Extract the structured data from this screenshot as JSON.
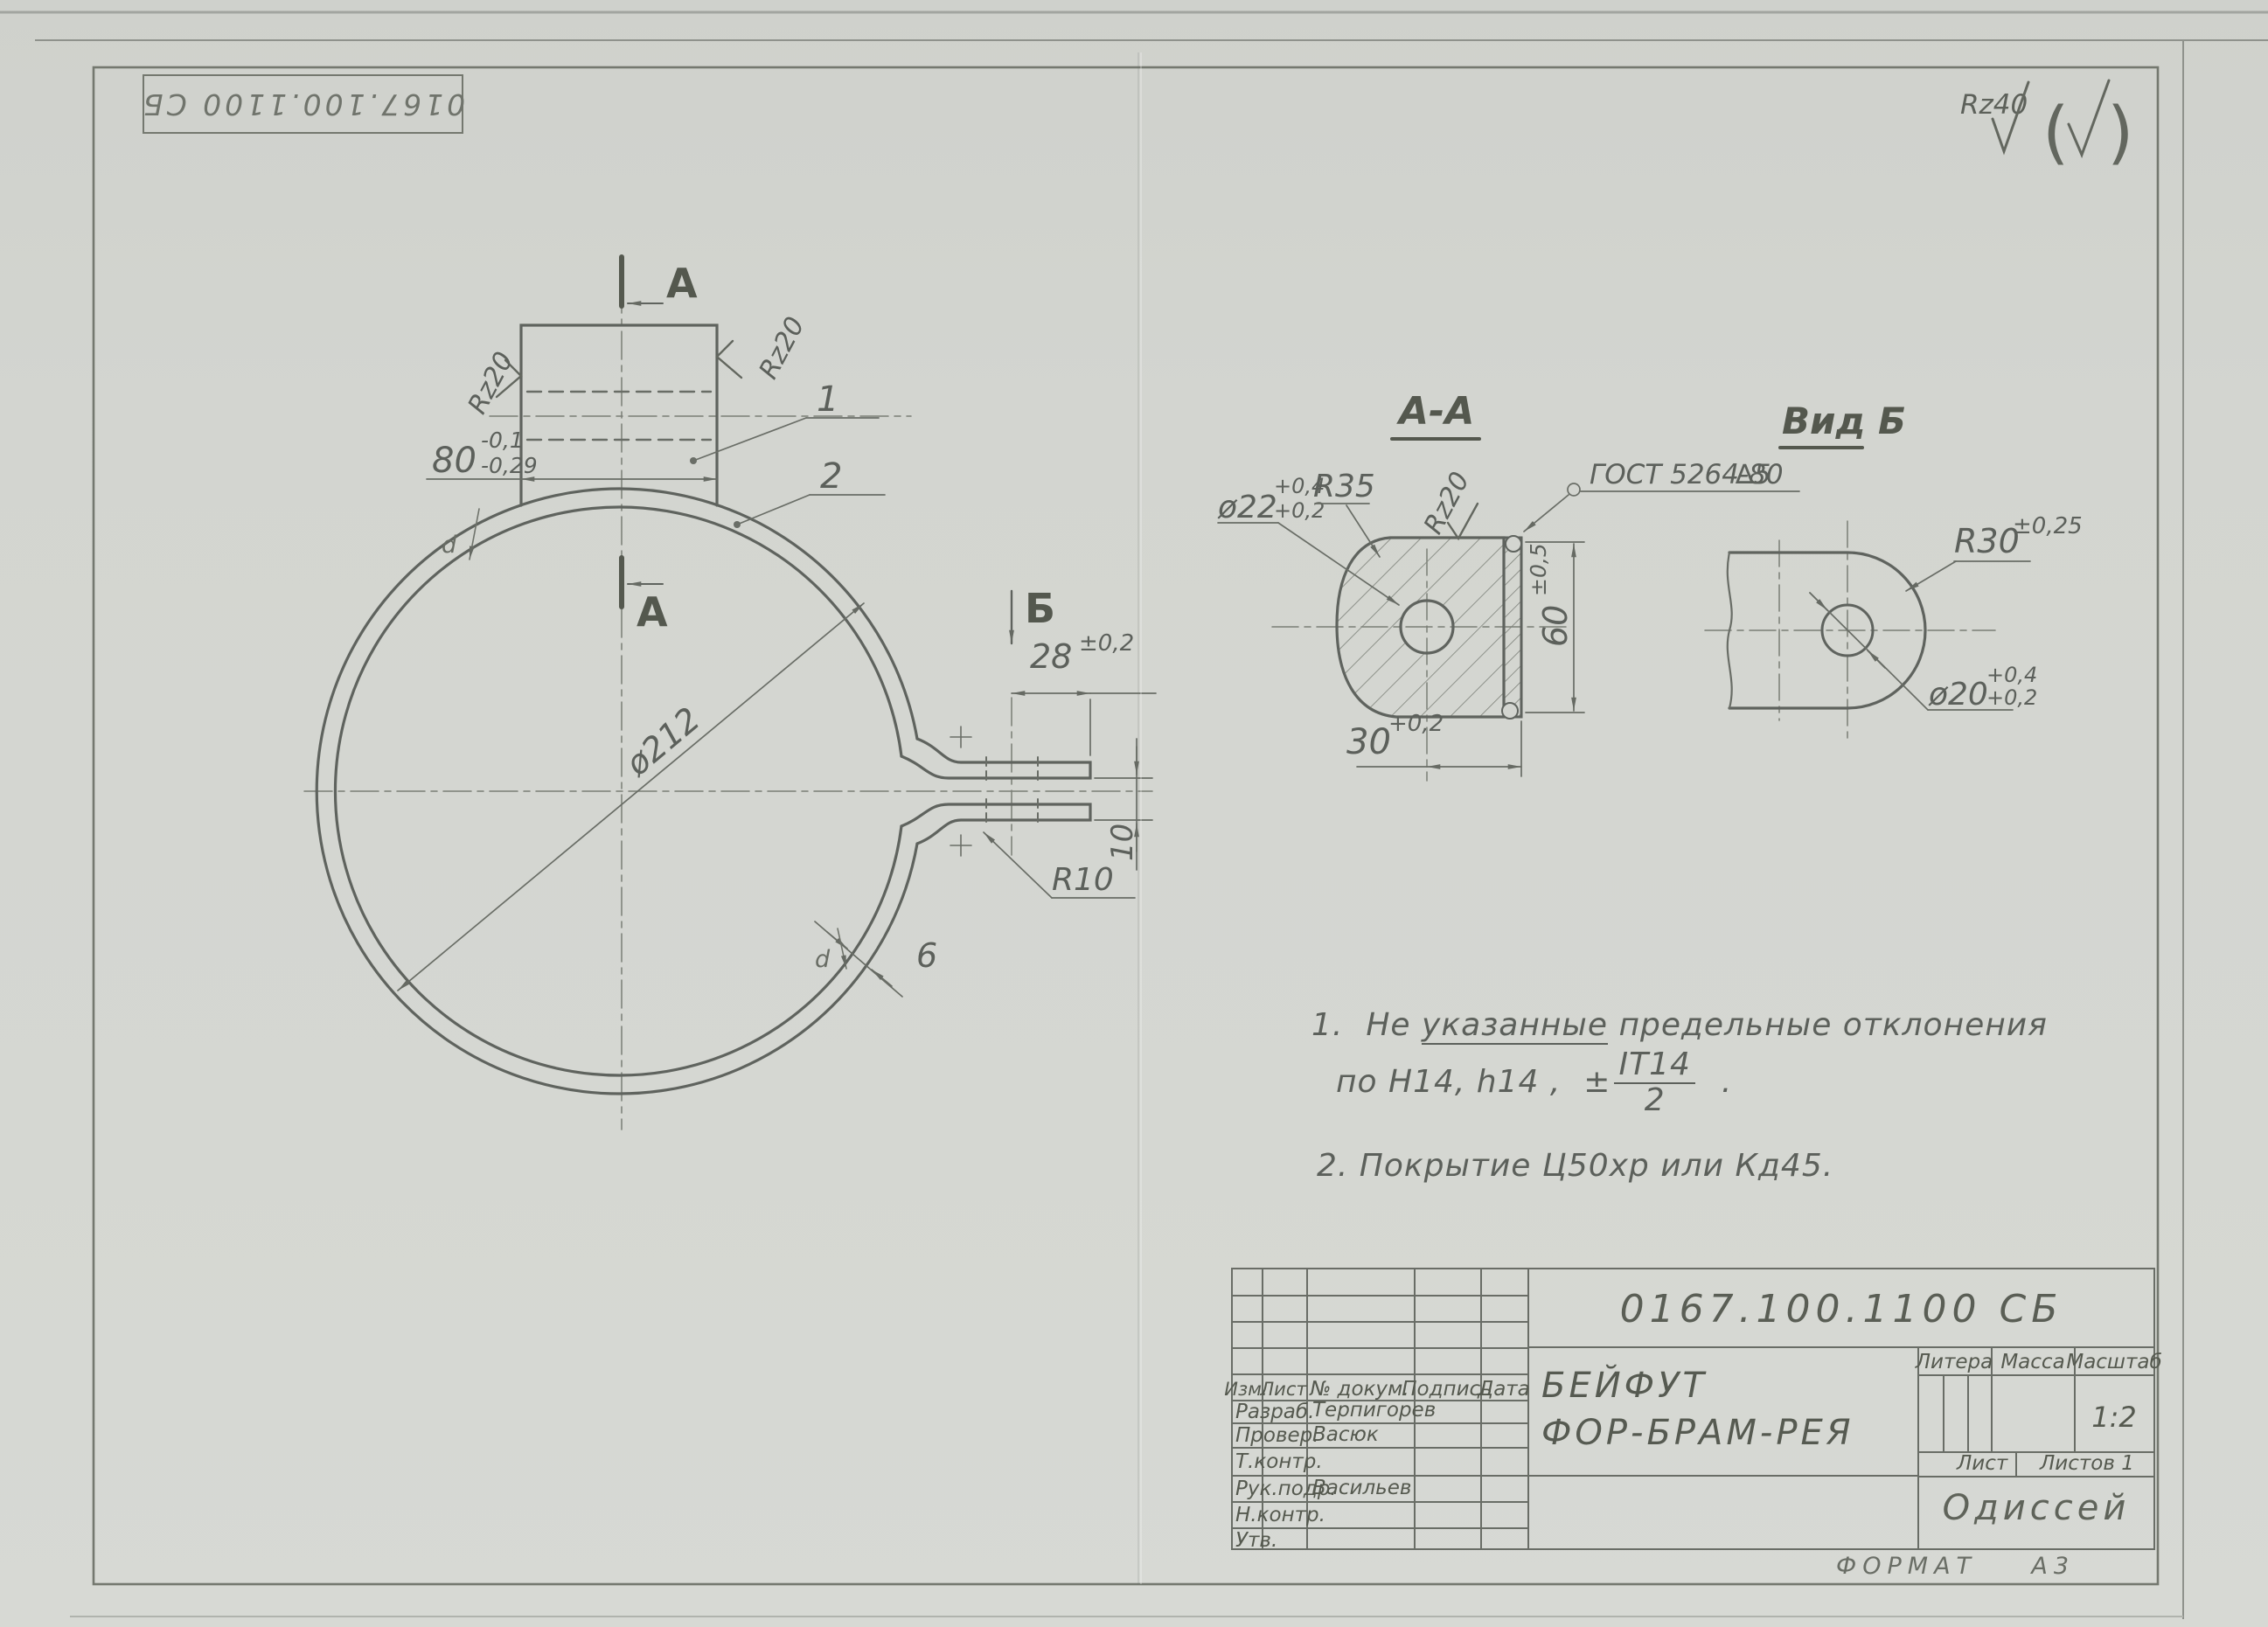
{
  "colors": {
    "paper": "#d3d5d0",
    "pencil": "#5f635e",
    "pencil_light": "#74786f"
  },
  "stamp": {
    "doc_number": "0167.100.1100 СБ"
  },
  "roughness_corner": {
    "label": "Rz40",
    "paren_open": "(",
    "paren_close": ")"
  },
  "main_view": {
    "section_label": "A",
    "view_label": "Б",
    "dim_80": {
      "value": "80",
      "tol_upper": "-0,1",
      "tol_lower": "-0,29"
    },
    "dim_diameter": "ø212",
    "dim_28": {
      "value": "28",
      "tol": "±0,2"
    },
    "dim_10": "10",
    "dim_r10": "R10",
    "dim_thickness": "6",
    "roughness": "Rz20",
    "callout_1": "1",
    "callout_2": "2",
    "weld_mark": "d"
  },
  "section_aa": {
    "title": "A-A",
    "dim_dia22": {
      "value": "ø22",
      "tol_upper": "+0,4",
      "tol_lower": "+0,2"
    },
    "dim_r35": "R35",
    "roughness": "Rz20",
    "weld_note": "ГОСТ 5264-80",
    "weld_size": "∆5",
    "dim_60": {
      "value": "60",
      "tol": "±0,5"
    },
    "dim_30": {
      "value": "30",
      "tol": "+0,2"
    }
  },
  "view_b": {
    "title": "Вид Б",
    "dim_r30": {
      "value": "R30",
      "tol": "±0,25"
    },
    "dim_dia20": {
      "value": "ø20",
      "tol_upper": "+0,4",
      "tol_lower": "+0,2"
    }
  },
  "notes": {
    "n1_num": "1.",
    "n1_a": "Не ",
    "n1_underlined": "указанные",
    "n1_b": " предельные отклонения",
    "n1_line2": "по   H14, h14 ,",
    "n1_pm": "±",
    "n1_frac_num": "IT14",
    "n1_frac_den": "2",
    "n1_end": ".",
    "n2": "2.   Покрытие   Ц50хр   или   Кд45."
  },
  "title_block": {
    "doc_number": "0167.100.1100 СБ",
    "name_line1": "БЕЙФУТ",
    "name_line2": "ФОР-БРАМ-РЕЯ",
    "org": "Одиссей",
    "litera_label": "Литера",
    "mass_label": "Масса",
    "scale_label": "Масштаб",
    "scale_value": "1:2",
    "sheet_label": "Лист",
    "sheets_label": "Листов 1",
    "header": {
      "izm": "Изм.",
      "list": "Лист",
      "doc": "№ докум.",
      "sign": "Подпись",
      "date": "Дата"
    },
    "rows": [
      {
        "role": "Разраб.",
        "name": "Терпигорев"
      },
      {
        "role": "Провер.",
        "name": "Васюк"
      },
      {
        "role": "Т.контр.",
        "name": ""
      },
      {
        "role": "Рук.подр.",
        "name": "Васильев"
      },
      {
        "role": "Н.контр.",
        "name": ""
      },
      {
        "role": "Утв.",
        "name": ""
      }
    ]
  },
  "format_note": {
    "label": "ФОРМАТ",
    "value": "А3"
  }
}
